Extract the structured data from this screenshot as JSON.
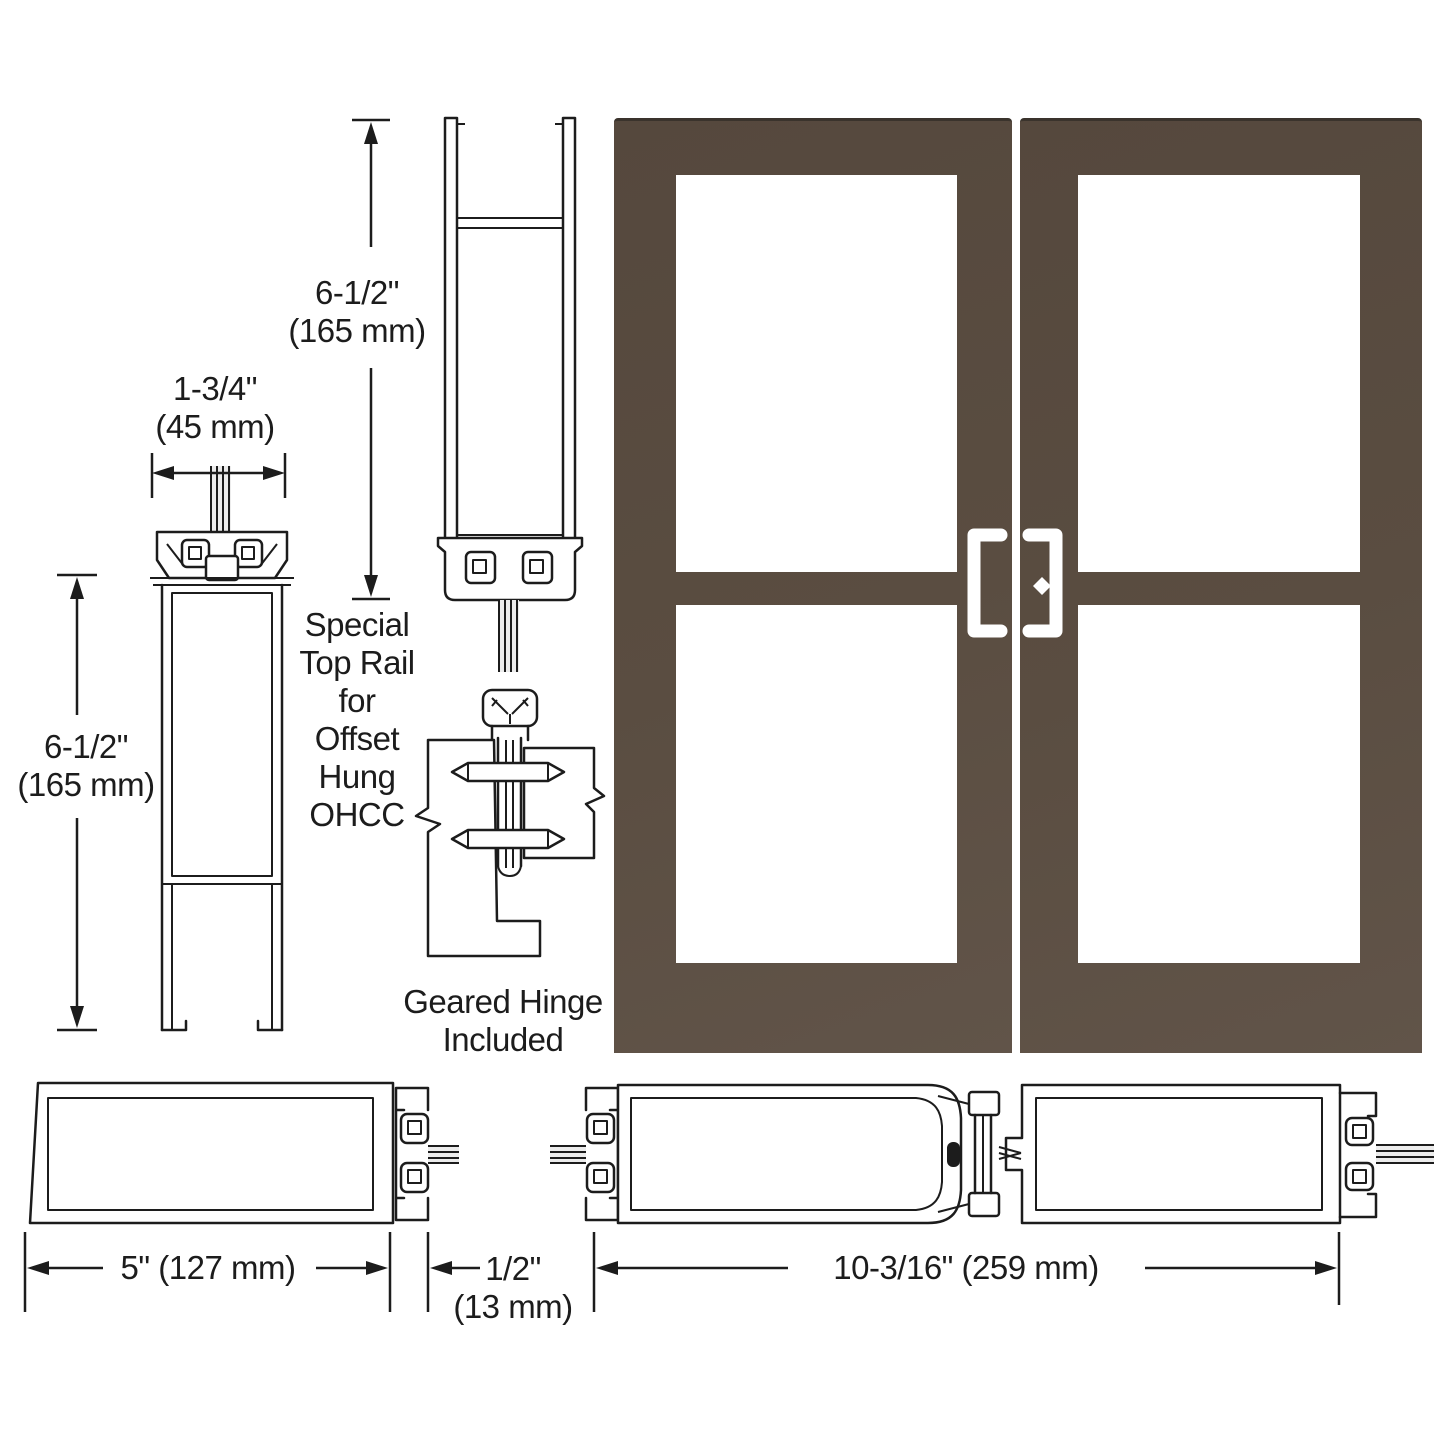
{
  "diagram": {
    "type": "door-hardware-technical-drawing",
    "subject": "Pair of bronze anodized wide-stile entrance doors with profile cross-sections",
    "colors": {
      "background": "#ffffff",
      "line": "#1c1c1c",
      "door_bronze": "#5a4d41",
      "door_top_edge": "#3a332c",
      "glass": "#ffffff",
      "pin_fill": "#ececec"
    },
    "annotations": {
      "top_rail_width": "1-3/4\"\n(45 mm)",
      "bottom_rail_height": "6-1/2\"\n(165 mm)",
      "top_rail_height": "6-1/2\"\n(165 mm)",
      "special_top_rail_note": "Special\nTop Rail\nfor\nOffset\nHung\nOHCC",
      "geared_hinge_note": "Geared Hinge\nIncluded",
      "bottom_rail_width": "5\" (127 mm)",
      "meeting_stile_gap": "1/2\"\n(13 mm)",
      "hinge_stile_pair_width": "10-3/16\" (259 mm)"
    },
    "door_elevation": {
      "leaves": 2,
      "hardware": [
        "offset-pull-handle-left-leaf",
        "offset-pull-handle-right-leaf",
        "cylinder-lock-right-leaf"
      ]
    }
  }
}
